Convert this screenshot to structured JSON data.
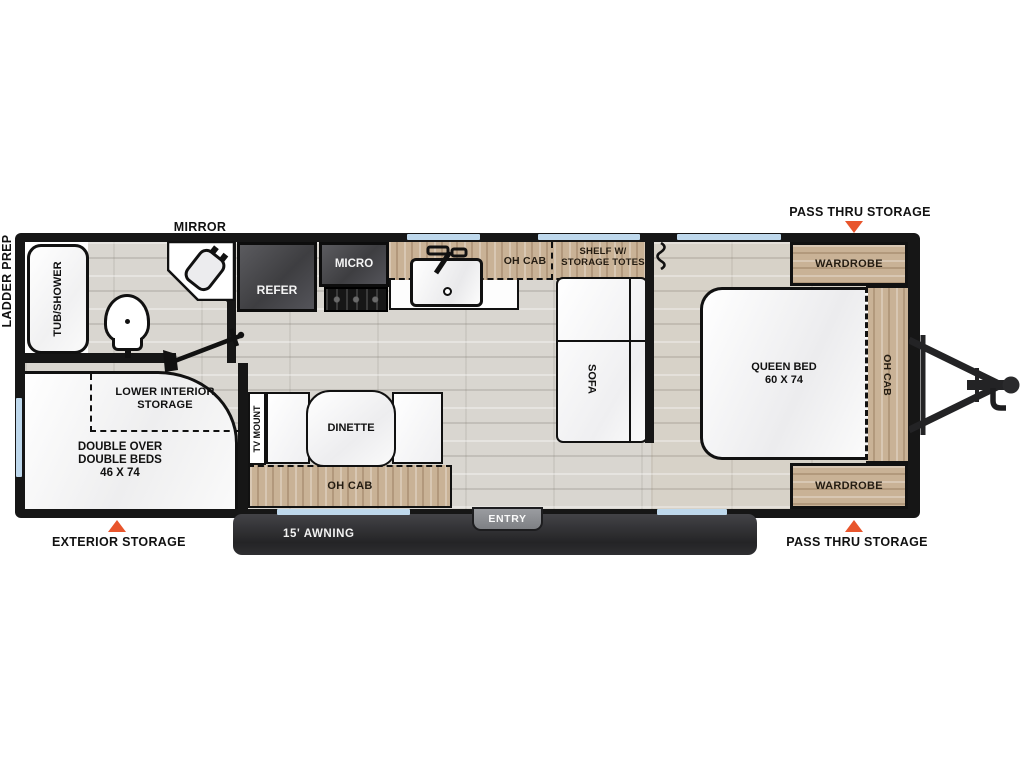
{
  "callouts": {
    "pass_thru_storage_top": "PASS THRU STORAGE",
    "pass_thru_storage_bottom": "PASS THRU STORAGE",
    "mirror": "MIRROR",
    "ladder_prep": "LADDER PREP",
    "exterior_storage": "EXTERIOR STORAGE",
    "awning_length": "15' AWNING",
    "entry": "ENTRY"
  },
  "bathroom": {
    "tub_shower": "TUB/SHOWER"
  },
  "kitchen": {
    "refer": "REFER",
    "micro": "MICRO",
    "oh_cab": "OH CAB",
    "shelf_totes": "SHELF W/ STORAGE TOTES"
  },
  "living": {
    "sofa": "SOFA",
    "tv_mount": "TV MOUNT",
    "dinette": "DINETTE",
    "oh_cab": "OH CAB"
  },
  "bedroom": {
    "queen_bed": "QUEEN BED",
    "queen_bed_size": "60 X 74",
    "wardrobe_rear": "WARDROBE",
    "wardrobe_front": "WARDROBE",
    "oh_cab": "OH CAB"
  },
  "bunk_room": {
    "bed": "DOUBLE OVER DOUBLE BEDS",
    "bed_size": "46 X 74",
    "storage": "LOWER INTERIOR STORAGE"
  },
  "colors": {
    "wall": "#161616",
    "cabinet_wood": "#c9b296",
    "floor": "#d9d6d0",
    "window": "#bed8ec",
    "marker": "#e8552c",
    "appliance": "#4a4a4e",
    "awning": "#2e2e31"
  }
}
